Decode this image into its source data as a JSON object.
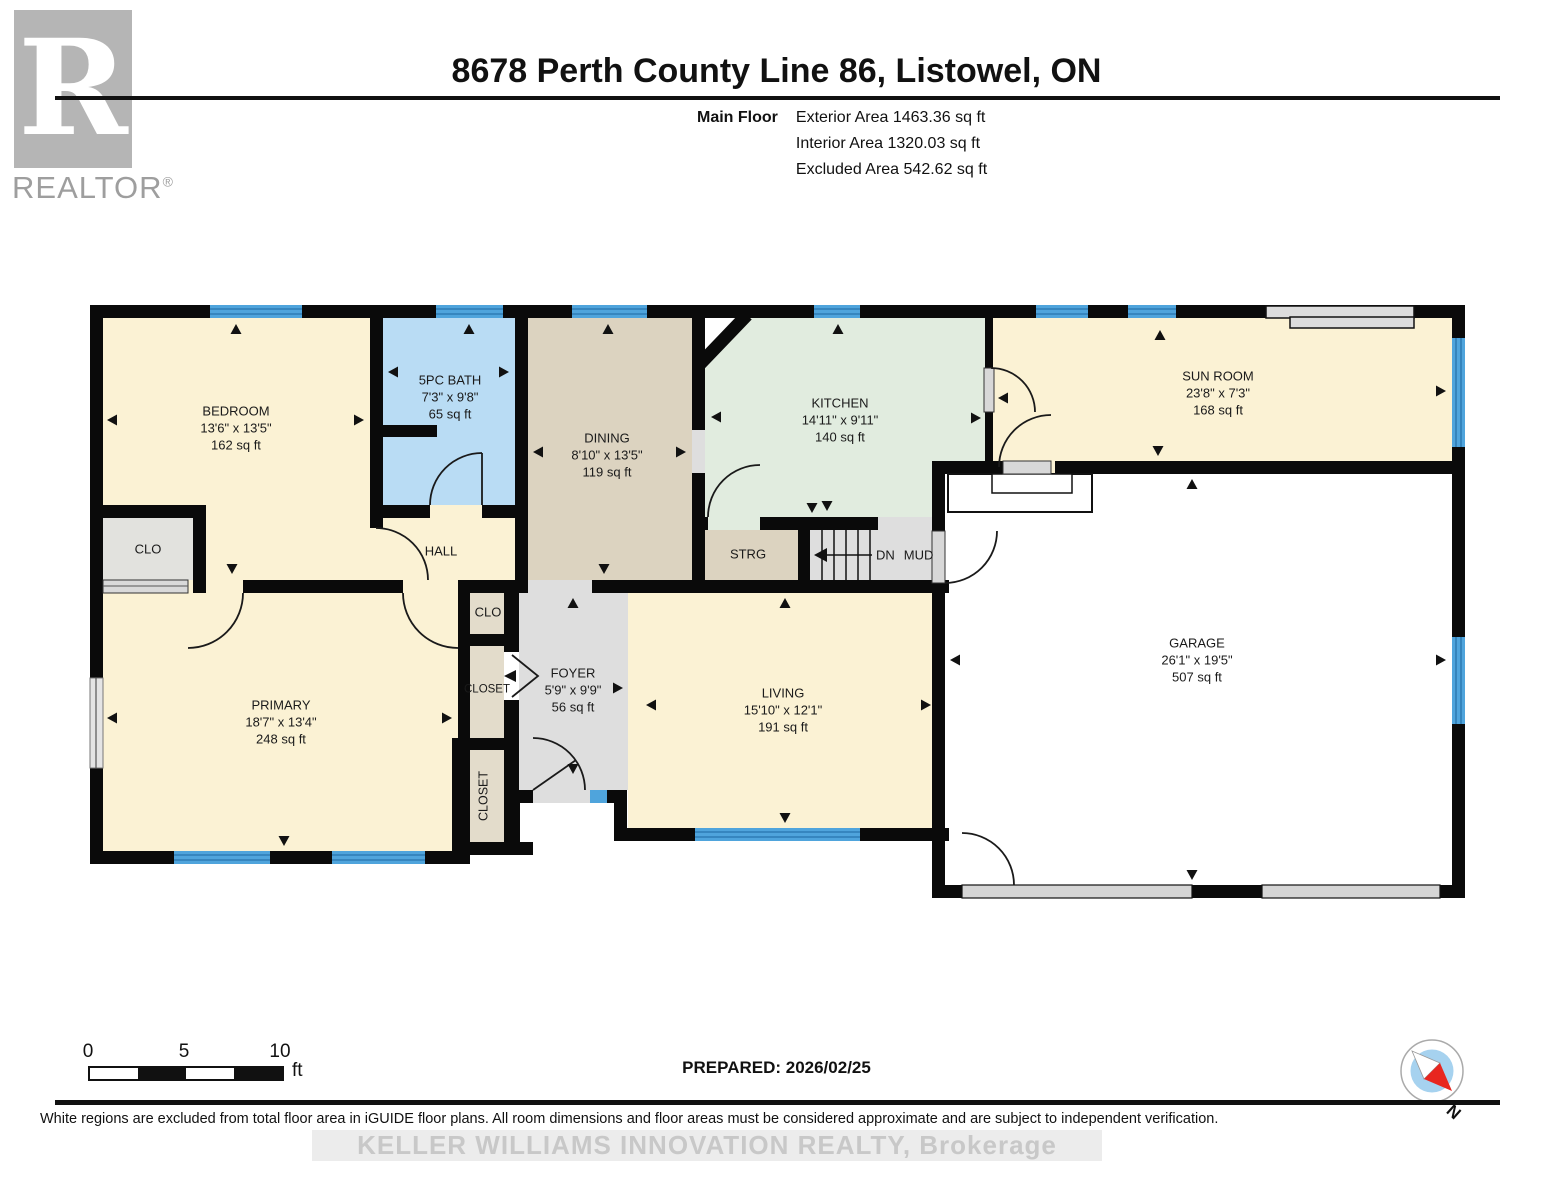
{
  "header": {
    "logo": {
      "letter": "R",
      "brand": "REALTOR",
      "reg": "®"
    },
    "title": "8678 Perth County Line 86, Listowel, ON",
    "floor_label": "Main Floor",
    "stats": [
      {
        "label": "Exterior Area",
        "value": "1463.36 sq ft"
      },
      {
        "label": "Interior Area",
        "value": "1320.03 sq ft"
      },
      {
        "label": "Excluded Area",
        "value": "542.62 sq ft"
      }
    ]
  },
  "rooms": {
    "bedroom": {
      "name": "BEDROOM",
      "dims": "13'6\" x 13'5\"",
      "area": "162 sq ft"
    },
    "bath": {
      "name": "5PC BATH",
      "dims": "7'3\" x 9'8\"",
      "area": "65 sq ft"
    },
    "dining": {
      "name": "DINING",
      "dims": "8'10\" x 13'5\"",
      "area": "119 sq ft"
    },
    "kitchen": {
      "name": "KITCHEN",
      "dims": "14'11\" x 9'11\"",
      "area": "140 sq ft"
    },
    "sunroom": {
      "name": "SUN ROOM",
      "dims": "23'8\" x 7'3\"",
      "area": "168 sq ft"
    },
    "garage": {
      "name": "GARAGE",
      "dims": "26'1\" x 19'5\"",
      "area": "507 sq ft"
    },
    "primary": {
      "name": "PRIMARY",
      "dims": "18'7\" x 13'4\"",
      "area": "248 sq ft"
    },
    "living": {
      "name": "LIVING",
      "dims": "15'10\" x 12'1\"",
      "area": "191 sq ft"
    },
    "foyer": {
      "name": "FOYER",
      "dims": "5'9\" x 9'9\"",
      "area": "56 sq ft"
    }
  },
  "labels": {
    "hall": "HALL",
    "clo_bedroom": "CLO",
    "clo_foyer": "CLO",
    "closet_mid": "CLOSET",
    "closet_bottom": "CLOSET",
    "strg": "STRG",
    "stairs_dn": "DN",
    "mud": "MUD"
  },
  "scale_bar": {
    "ticks": [
      "0",
      "5",
      "10"
    ],
    "unit": "ft"
  },
  "compass": {
    "north_label": "N"
  },
  "footer": {
    "prepared": "PREPARED: 2026/02/25",
    "disclaimer": "White regions are excluded from total floor area in iGUIDE floor plans. All room dimensions and floor areas must be considered approximate and are subject to independent verification.",
    "watermark": "KELLER WILLIAMS INNOVATION REALTY, Brokerage"
  },
  "colors": {
    "wall": "#0A0A0A",
    "window": "#4FA4DC",
    "window_line": "#2F7DB5",
    "room_cream": "#FBF2D4",
    "bath_blue": "#B9DCF4",
    "dining_tan": "#DCD3C0",
    "kitchen_green": "#E1ECDF",
    "closet_tan": "#E3DCCB",
    "closet_gray": "#E2E2DE",
    "floor_gray": "#DEDEDE",
    "garage_white": "#FFFFFF",
    "compass_red": "#E8261F",
    "compass_blue": "#A6D2EF"
  }
}
